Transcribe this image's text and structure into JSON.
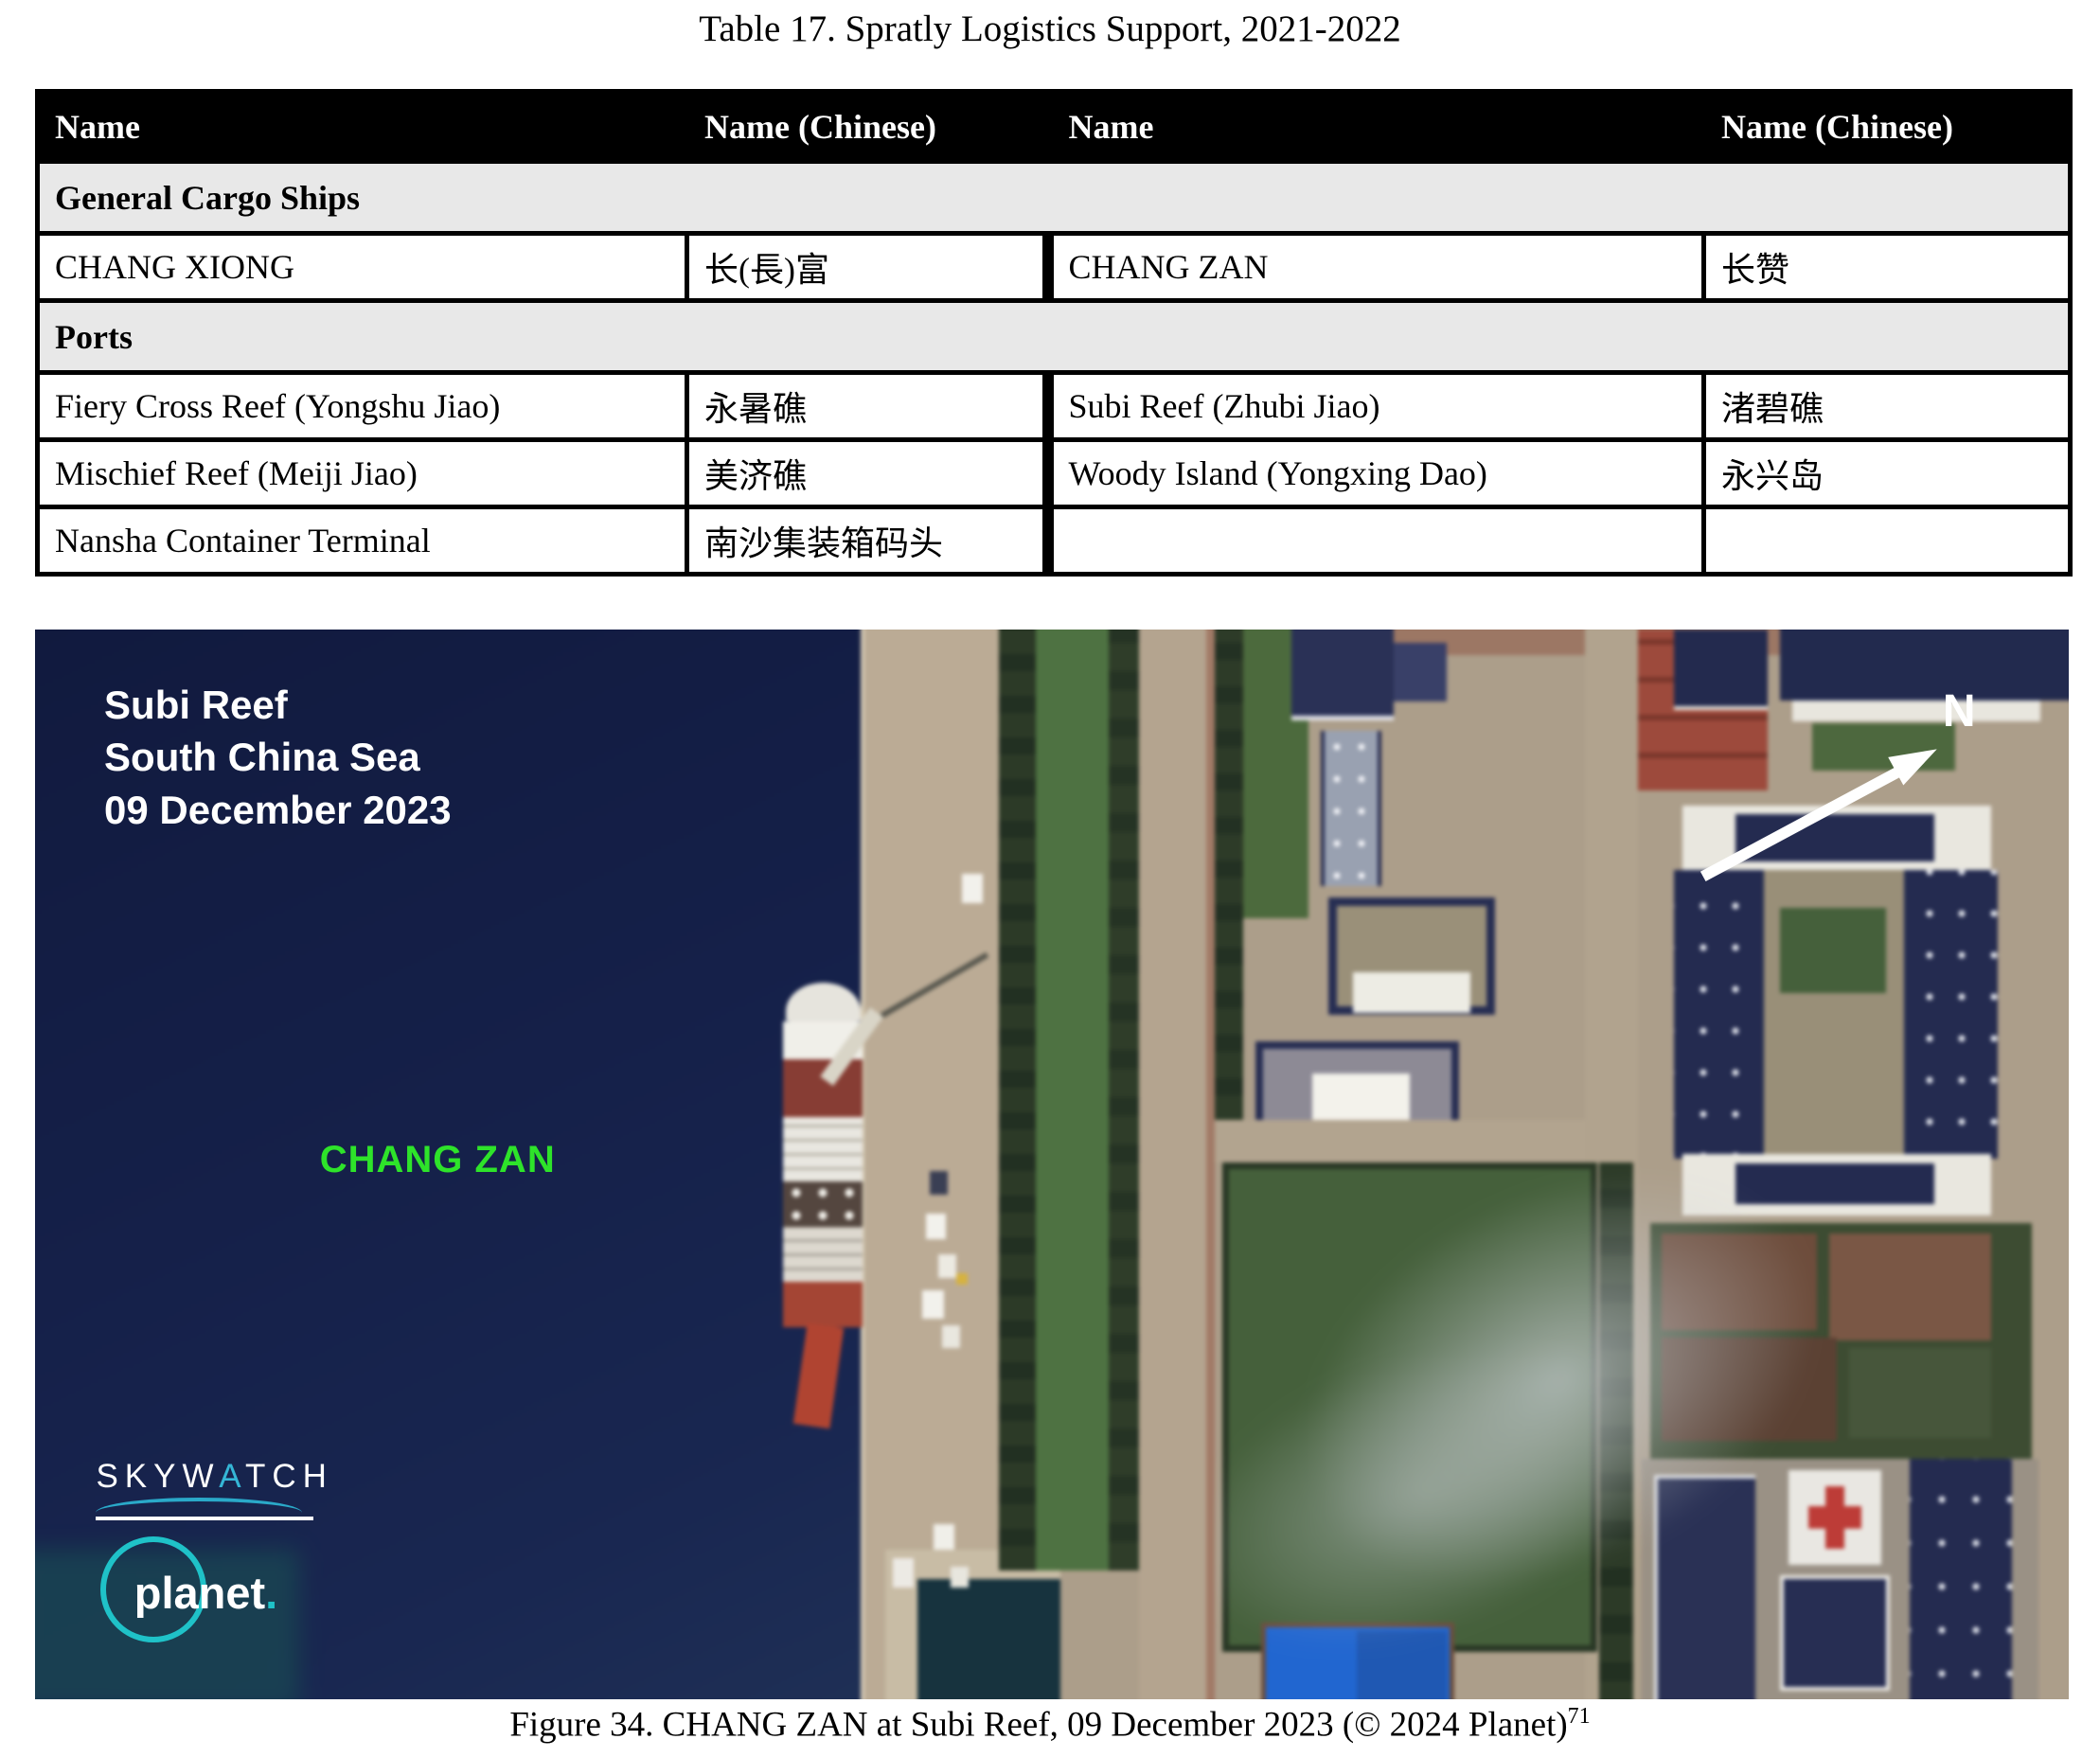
{
  "title": "Table 17. Spratly Logistics Support, 2021-2022",
  "table": {
    "headers": [
      "Name",
      "Name (Chinese)",
      "Name",
      "Name (Chinese)"
    ],
    "header_bg": "#000000",
    "header_text_color": "#ffffff",
    "section_bg": "#e8e8e8",
    "sections": [
      {
        "label": "General Cargo Ships",
        "rows": [
          [
            "CHANG XIONG",
            "长(長)富",
            "CHANG ZAN",
            "长赞"
          ]
        ]
      },
      {
        "label": "Ports",
        "rows": [
          [
            "Fiery Cross Reef (Yongshu Jiao)",
            "永暑礁",
            "Subi Reef (Zhubi Jiao)",
            "渚碧礁"
          ],
          [
            "Mischief Reef (Meiji Jiao)",
            "美济礁",
            "Woody Island (Yongxing Dao)",
            "永兴岛"
          ],
          [
            "Nansha Container Terminal",
            "南沙集装箱码头",
            "",
            ""
          ]
        ]
      }
    ]
  },
  "figure": {
    "overlay": {
      "line1": "Subi Reef",
      "line2": "South China Sea",
      "line3": "09 December 2023"
    },
    "ship_label": "CHANG ZAN",
    "north_label": "N",
    "logos": {
      "skywatch_part1": "SKYW",
      "skywatch_a": "A",
      "skywatch_part2": "TCH",
      "planet_text": "planet",
      "planet_dot": "."
    },
    "caption": "Figure 34. CHANG ZAN at Subi Reef, 09 December 2023 (© 2024 Planet)",
    "caption_superscript": "71",
    "colors": {
      "water": "#14204b",
      "ship_label_green": "#2ee32a",
      "skywatch_cyan": "#35b6d6",
      "planet_cyan": "#1fc2c8",
      "red_cross": "#c23b35",
      "pool_blue": "#1e66d6",
      "pier_tan": "#bcab94"
    }
  }
}
